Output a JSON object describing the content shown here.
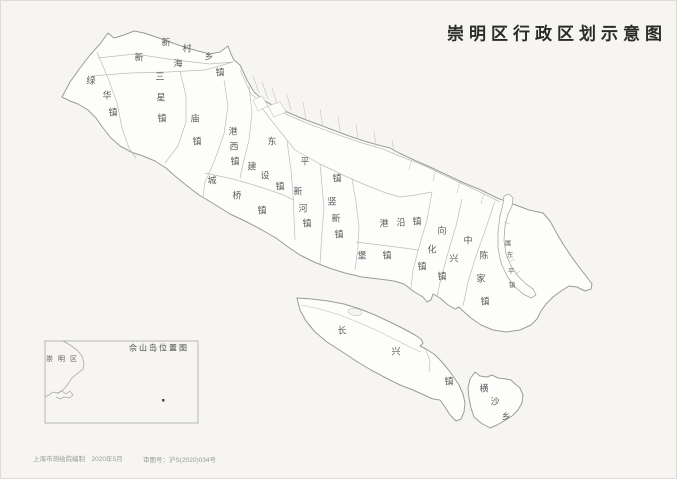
{
  "title": "崇明区行政区划示意图",
  "map": {
    "towns": [
      {
        "name": "新村乡",
        "chars": [
          {
            "c": "新",
            "x": 166,
            "y": 43
          },
          {
            "c": "村",
            "x": 187,
            "y": 49
          },
          {
            "c": "乡",
            "x": 209,
            "y": 57
          }
        ]
      },
      {
        "name": "新海镇",
        "chars": [
          {
            "c": "新",
            "x": 139,
            "y": 58
          },
          {
            "c": "海",
            "x": 178,
            "y": 64
          },
          {
            "c": "镇",
            "x": 220,
            "y": 73
          }
        ]
      },
      {
        "name": "绿华镇",
        "chars": [
          {
            "c": "绿",
            "x": 91,
            "y": 81
          },
          {
            "c": "华",
            "x": 107,
            "y": 96
          },
          {
            "c": "镇",
            "x": 113,
            "y": 113
          }
        ]
      },
      {
        "name": "三星镇",
        "chars": [
          {
            "c": "三",
            "x": 160,
            "y": 77
          },
          {
            "c": "星",
            "x": 161,
            "y": 98
          },
          {
            "c": "镇",
            "x": 162,
            "y": 119
          }
        ]
      },
      {
        "name": "庙镇",
        "chars": [
          {
            "c": "庙",
            "x": 195,
            "y": 119
          },
          {
            "c": "镇",
            "x": 197,
            "y": 142
          }
        ]
      },
      {
        "name": "港西镇",
        "chars": [
          {
            "c": "港",
            "x": 233,
            "y": 132
          },
          {
            "c": "西",
            "x": 234,
            "y": 147
          },
          {
            "c": "镇",
            "x": 235,
            "y": 162
          }
        ]
      },
      {
        "name": "建设镇",
        "chars": [
          {
            "c": "建",
            "x": 252,
            "y": 167
          },
          {
            "c": "设",
            "x": 265,
            "y": 176
          },
          {
            "c": "镇",
            "x": 280,
            "y": 187
          }
        ]
      },
      {
        "name": "城桥镇",
        "chars": [
          {
            "c": "城",
            "x": 212,
            "y": 181
          },
          {
            "c": "桥",
            "x": 237,
            "y": 196
          },
          {
            "c": "镇",
            "x": 262,
            "y": 211
          }
        ]
      },
      {
        "name": "东平镇",
        "chars": [
          {
            "c": "东",
            "x": 272,
            "y": 142
          },
          {
            "c": "平",
            "x": 305,
            "y": 162
          },
          {
            "c": "镇",
            "x": 337,
            "y": 179
          }
        ]
      },
      {
        "name": "新河镇",
        "chars": [
          {
            "c": "新",
            "x": 298,
            "y": 192
          },
          {
            "c": "河",
            "x": 303,
            "y": 209
          },
          {
            "c": "镇",
            "x": 307,
            "y": 224
          }
        ]
      },
      {
        "name": "竖新镇",
        "chars": [
          {
            "c": "竖",
            "x": 332,
            "y": 202
          },
          {
            "c": "新",
            "x": 336,
            "y": 219
          },
          {
            "c": "镇",
            "x": 339,
            "y": 235
          }
        ]
      },
      {
        "name": "港沿镇",
        "chars": [
          {
            "c": "港",
            "x": 384,
            "y": 224
          },
          {
            "c": "沿",
            "x": 401,
            "y": 223
          },
          {
            "c": "镇",
            "x": 417,
            "y": 222
          }
        ]
      },
      {
        "name": "堡镇",
        "chars": [
          {
            "c": "堡",
            "x": 362,
            "y": 256
          },
          {
            "c": "镇",
            "x": 387,
            "y": 256
          }
        ]
      },
      {
        "name": "向化镇",
        "chars": [
          {
            "c": "向",
            "x": 442,
            "y": 231
          },
          {
            "c": "化",
            "x": 432,
            "y": 250
          },
          {
            "c": "镇",
            "x": 422,
            "y": 267
          }
        ]
      },
      {
        "name": "中兴镇",
        "chars": [
          {
            "c": "中",
            "x": 468,
            "y": 241
          },
          {
            "c": "兴",
            "x": 454,
            "y": 259
          },
          {
            "c": "镇",
            "x": 442,
            "y": 277
          }
        ]
      },
      {
        "name": "陈家镇",
        "chars": [
          {
            "c": "陈",
            "x": 484,
            "y": 256
          },
          {
            "c": "家",
            "x": 481,
            "y": 279
          },
          {
            "c": "镇",
            "x": 485,
            "y": 302
          }
        ]
      },
      {
        "name": "属东平镇",
        "small": true,
        "chars": [
          {
            "c": "属",
            "x": 508,
            "y": 244
          },
          {
            "c": "东",
            "x": 510,
            "y": 256
          },
          {
            "c": "平",
            "x": 511,
            "y": 272
          },
          {
            "c": "镇",
            "x": 512,
            "y": 286
          }
        ]
      },
      {
        "name": "长兴镇",
        "chars": [
          {
            "c": "长",
            "x": 342,
            "y": 331
          },
          {
            "c": "兴",
            "x": 396,
            "y": 352
          },
          {
            "c": "镇",
            "x": 449,
            "y": 382
          }
        ]
      },
      {
        "name": "横沙乡",
        "chars": [
          {
            "c": "横",
            "x": 484,
            "y": 389
          },
          {
            "c": "沙",
            "x": 495,
            "y": 402
          },
          {
            "c": "乡",
            "x": 506,
            "y": 417
          }
        ]
      }
    ]
  },
  "inset": {
    "title": "佘山岛位置图",
    "region_label": "崇明区"
  },
  "credits": {
    "left": "上海市测绘院编制　2020年5月",
    "right": "审图号：沪S(2020)034号"
  },
  "colors": {
    "paper": "#f6f5f1",
    "land": "#fdfdfb",
    "coastline": "#9b9b9b",
    "boundary": "#bdbdbd",
    "label": "#5c5c5c",
    "title": "#2b2b2b"
  }
}
